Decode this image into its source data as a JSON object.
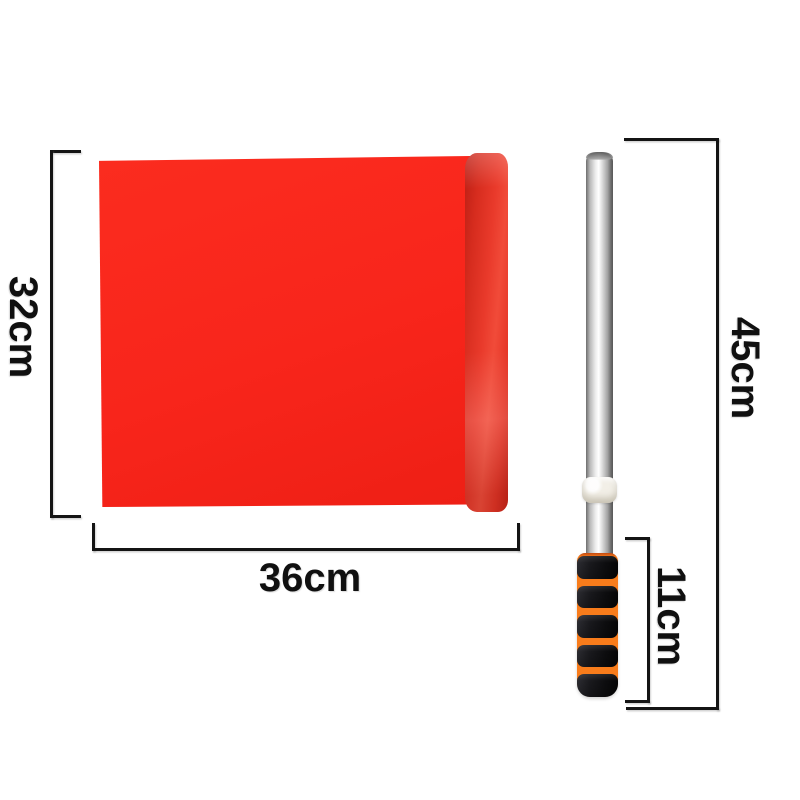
{
  "diagram": {
    "kind": "product-dimension-diagram",
    "measurements": {
      "flag_height": "32cm",
      "flag_width": "36cm",
      "pole_length": "45cm",
      "handle_length": "11cm"
    },
    "colors": {
      "background": "#ffffff",
      "dimension_line": "#141414",
      "label_text": "#101010",
      "flag_red": "#f8251b",
      "sleeve_red": "#d92c1e",
      "pole_silver": "#d6d6d6",
      "band_white": "#f2efe7",
      "grip_black": "#141417",
      "grip_orange": "#f87c1b"
    }
  }
}
